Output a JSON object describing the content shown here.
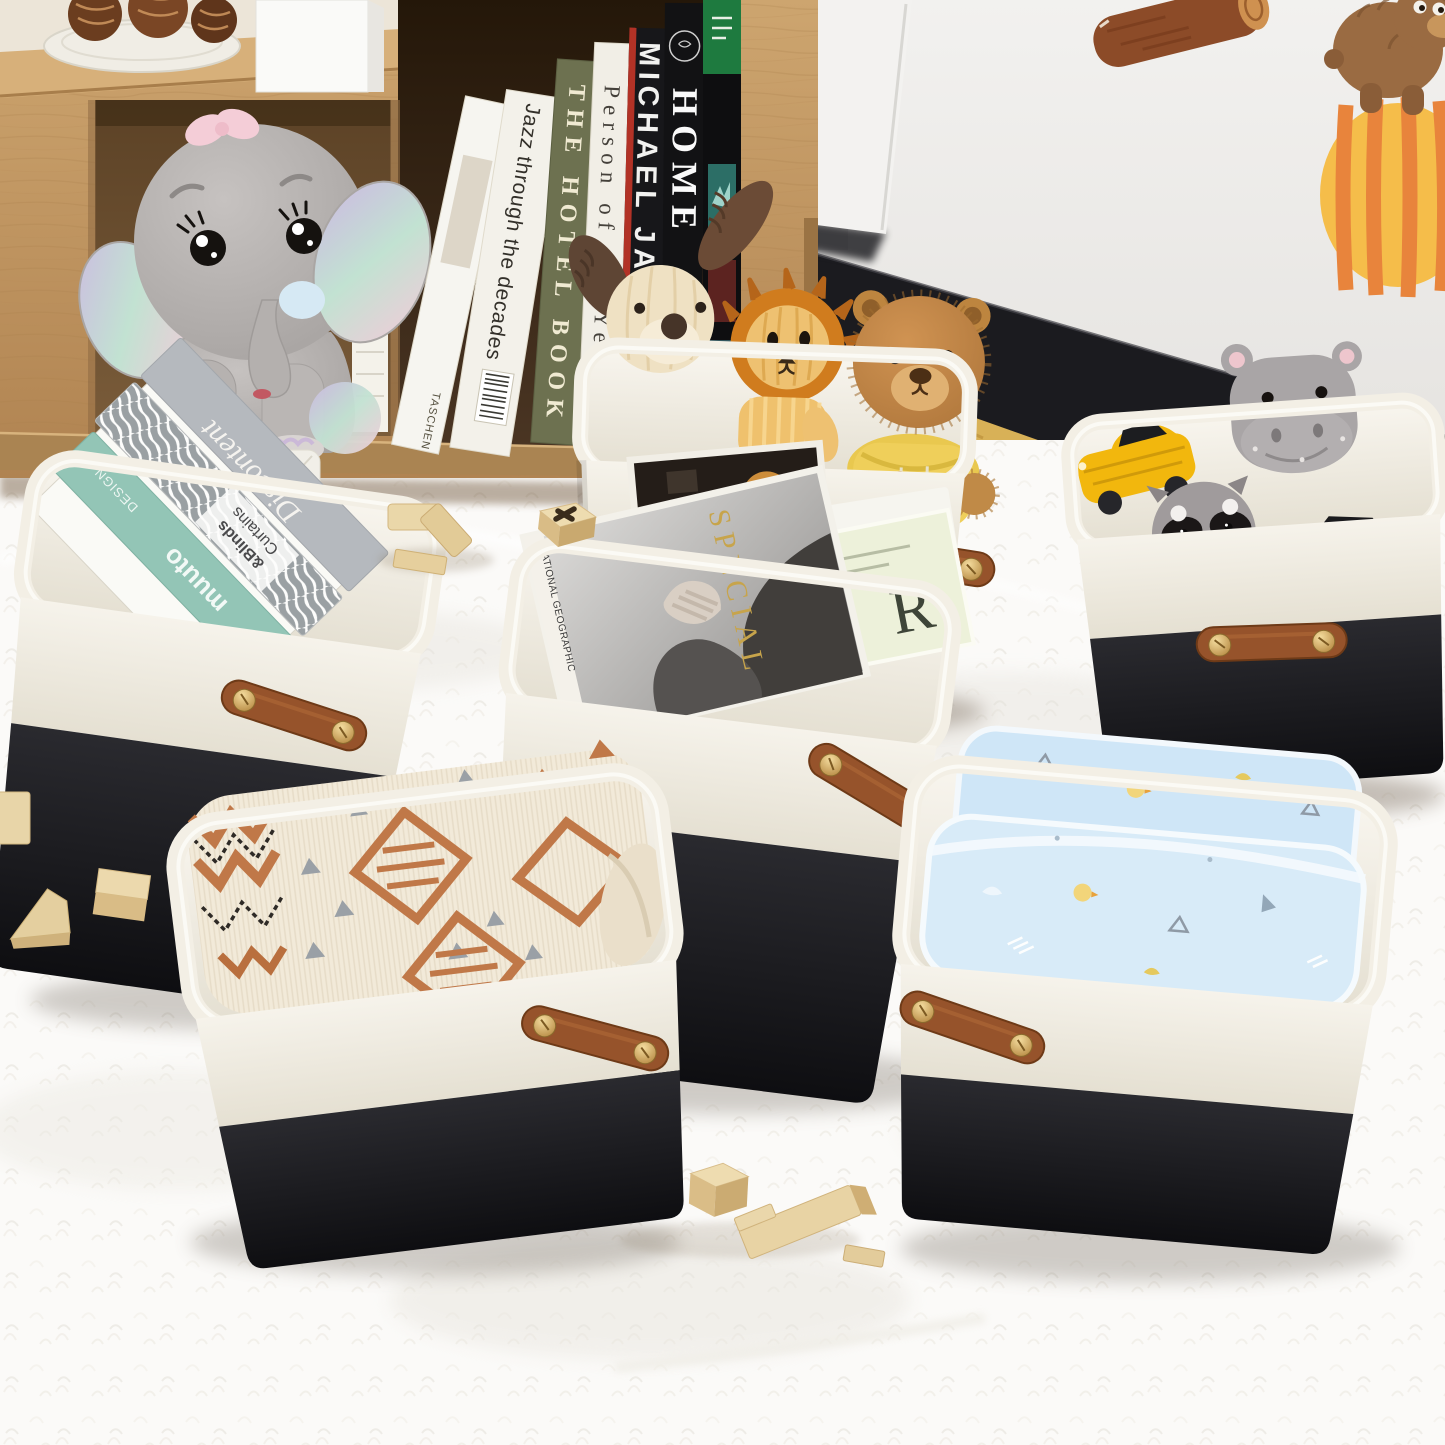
{
  "canvas": {
    "width": 1445,
    "height": 1445
  },
  "palette": {
    "wall": "#efeeec",
    "baseboard": "#1b1b1f",
    "carpet_tan": "#c69b74",
    "rug_white": "#fbfaf8",
    "wood": "#c9a06a",
    "basket_white": "#f2efe6",
    "basket_black": "#1b1b1e",
    "handle_brown": "#96532b",
    "rivet_gold": "#d9b267",
    "lining": "#f7f4ec",
    "blanket_rust": "#c07848",
    "baby_blue": "#d7eaf8"
  },
  "shelf": {
    "decor": [
      "pinecone-plate",
      "white-box"
    ],
    "plush": "rainbow-ear-elephant",
    "books": [
      {
        "title": "Jazz through the decades",
        "publisher": "TASCHEN"
      },
      {
        "title": "THE HOTEL BOOK"
      },
      {
        "title": "Person of the Year",
        "publisher": "TIM"
      },
      {
        "title": "MICHAEL JACKSON"
      },
      {
        "title": "HOME"
      },
      {
        "title": ""
      }
    ]
  },
  "wall_decals": [
    "log",
    "bear-on-striped-ball"
  ],
  "baskets": {
    "count": 6,
    "list": [
      {
        "id": "plush-basket-top",
        "contents": [
          "corduroy-dog",
          "corduroy-lion",
          "teddy-bear-in-yellow-hoodie"
        ]
      },
      {
        "id": "toy-basket-right",
        "contents": [
          "yellow-toy-car",
          "hippo-plush",
          "raccoon-plush",
          "red-toy-car"
        ]
      },
      {
        "id": "book-basket-left",
        "contents": [
          "gray-book",
          "striped-book",
          "teal-book"
        ]
      },
      {
        "id": "magazine-basket-center",
        "contents": [
          "photo-magazine",
          "green-magazine",
          "small-magazine"
        ]
      },
      {
        "id": "blanket-basket-bottom-left",
        "contents": [
          "aztec-knit-blanket"
        ]
      },
      {
        "id": "blanket-basket-bottom-right",
        "contents": [
          "blue-baby-blanket"
        ]
      }
    ]
  },
  "basket_books": [
    {
      "title": "Discontent"
    },
    {
      "line1": "Curtains",
      "line2": "&Blinds"
    },
    {
      "top": "DESIGN",
      "brand": "muuto",
      "corner": "NEW"
    }
  ],
  "magazines": {
    "cover_word": "SPECIAL",
    "spine_text": "NATIONAL GEOGRAPHIC",
    "green_initial": "R"
  },
  "blocks": [
    "arrow-block",
    "x-stamp-block",
    "cube-block",
    "square-block",
    "ramp-block",
    "plank-block"
  ]
}
